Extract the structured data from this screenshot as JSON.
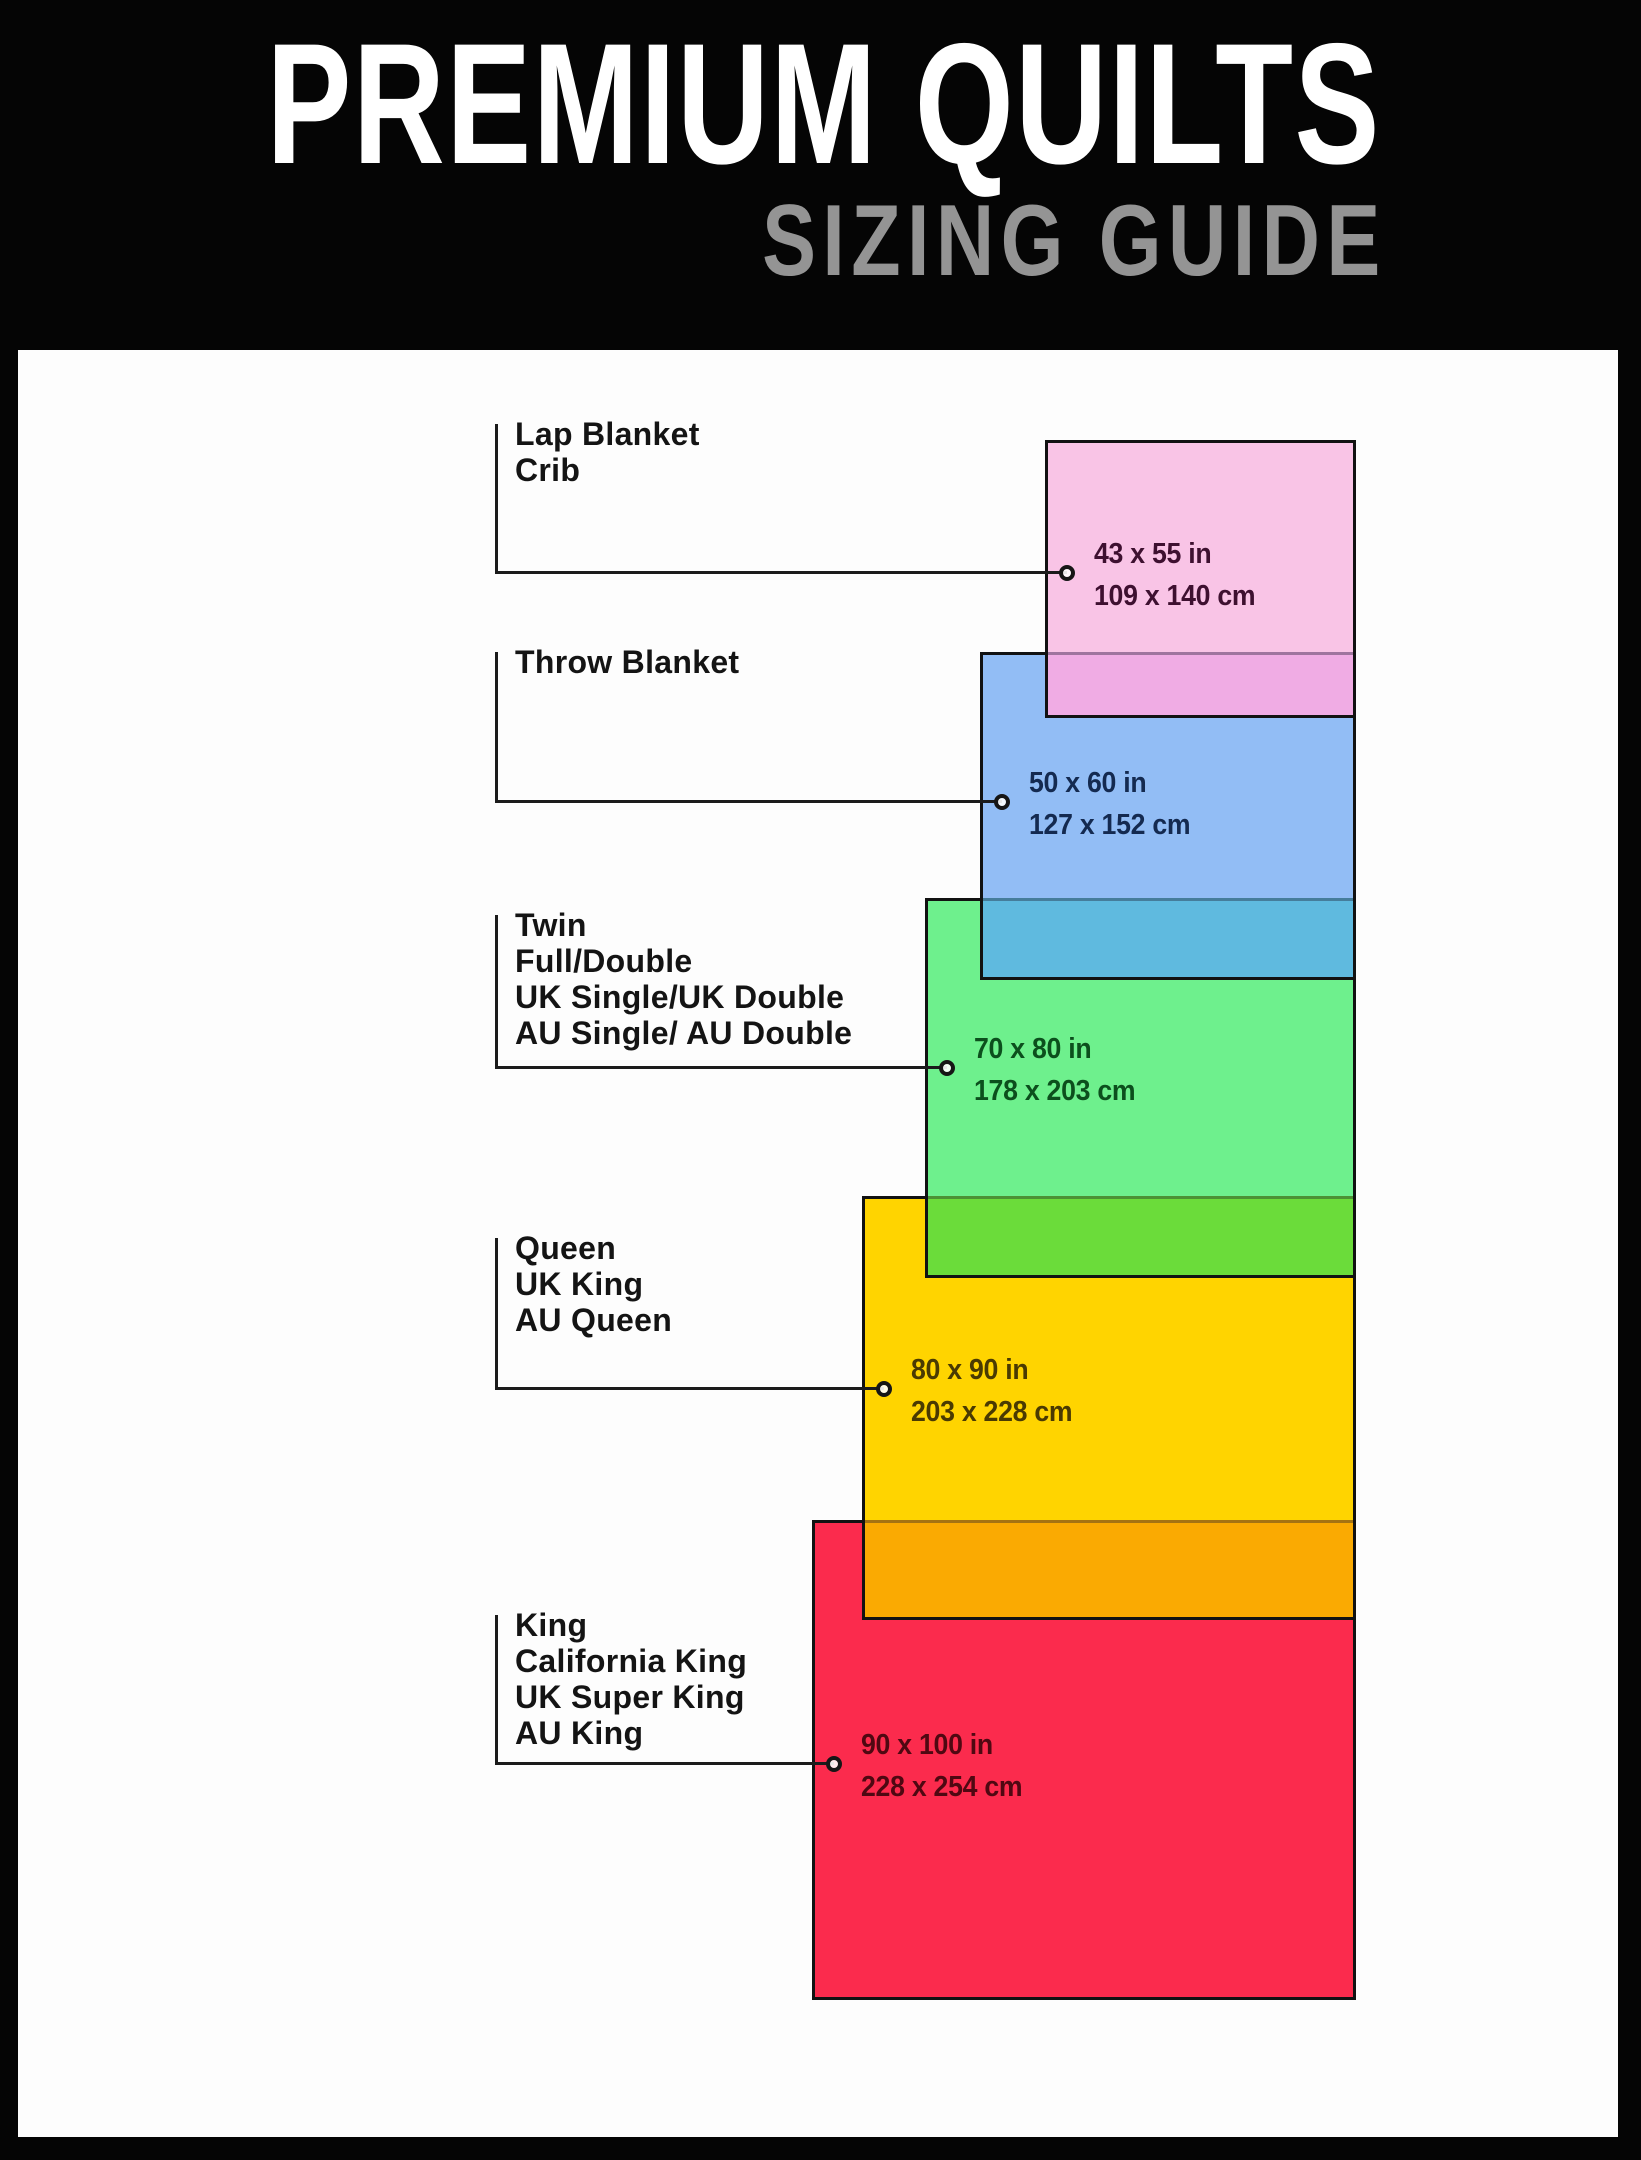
{
  "header": {
    "title": "PREMIUM QUILTS",
    "subtitle": "SIZING GUIDE"
  },
  "colors": {
    "background": "#050505",
    "panel": "#fdfdfd",
    "title_text": "#ffffff",
    "subtitle_text": "#949494",
    "label_text": "#141414",
    "connector": "#1b1b1b",
    "rect_border": "#121212"
  },
  "sizes": [
    {
      "names": [
        "Lap Blanket",
        "Crib"
      ],
      "inches": "43 x 55 in",
      "cm": "109 x 140 cm",
      "fill": "#F9C4E6",
      "overlap_fill": "#F0ACE4",
      "dim_text_color": "#3E1030",
      "layout": {
        "rect": {
          "left": 1045,
          "top": 440,
          "width": 311,
          "height": 278
        },
        "overlap_h": 66,
        "label_top": 424,
        "line_y": 573,
        "marker_x": 1067
      }
    },
    {
      "names": [
        "Throw Blanket"
      ],
      "inches": "50 x 60 in",
      "cm": "127 x 152 cm",
      "fill": "#92BDF5",
      "overlap_fill": "#5FBADF",
      "dim_text_color": "#142A50",
      "layout": {
        "rect": {
          "left": 980,
          "top": 652,
          "width": 376,
          "height": 328
        },
        "overlap_h": 82,
        "label_top": 652,
        "line_y": 802,
        "marker_x": 1002
      }
    },
    {
      "names": [
        "Twin",
        "Full/Double",
        "UK Single/UK Double",
        "AU Single/ AU Double"
      ],
      "inches": "70 x 80 in",
      "cm": "178 x 203 cm",
      "fill": "#6EF08D",
      "overlap_fill": "#6BDC3A",
      "dim_text_color": "#0C4F1D",
      "layout": {
        "rect": {
          "left": 925,
          "top": 898,
          "width": 431,
          "height": 380
        },
        "overlap_h": 82,
        "label_top": 915,
        "line_y": 1068,
        "marker_x": 947
      }
    },
    {
      "names": [
        "Queen",
        "UK King",
        "AU Queen"
      ],
      "inches": "80 x 90 in",
      "cm": "203 x 228 cm",
      "fill": "#FFD400",
      "overlap_fill": "#FAAA02",
      "dim_text_color": "#4A3A02",
      "layout": {
        "rect": {
          "left": 862,
          "top": 1196,
          "width": 494,
          "height": 424
        },
        "overlap_h": 100,
        "label_top": 1238,
        "line_y": 1389,
        "marker_x": 884
      }
    },
    {
      "names": [
        "King",
        "California King",
        "UK Super King",
        "AU King"
      ],
      "inches": "90 x 100 in",
      "cm": "228 x 254 cm",
      "fill": "#FB2B4D",
      "overlap_fill": null,
      "dim_text_color": "#4F0812",
      "layout": {
        "rect": {
          "left": 812,
          "top": 1520,
          "width": 544,
          "height": 480
        },
        "overlap_h": 0,
        "label_top": 1615,
        "line_y": 1764,
        "marker_x": 834
      }
    }
  ]
}
